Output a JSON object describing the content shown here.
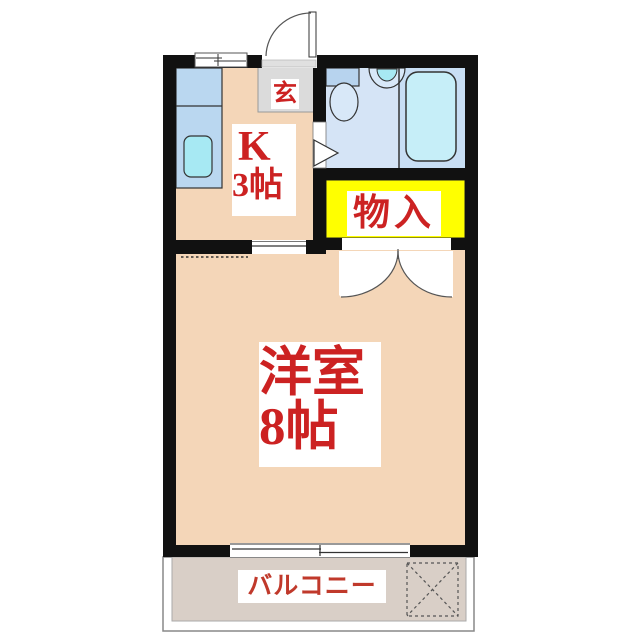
{
  "title": "1K apartment floor plan",
  "rooms": {
    "entrance": {
      "label": "玄"
    },
    "kitchen": {
      "label_line1": "K",
      "label_line2": "3帖"
    },
    "storage": {
      "label": "物入"
    },
    "main_room": {
      "label_line1": "洋室",
      "label_line2": "8帖"
    },
    "balcony": {
      "label": "バルコニー"
    }
  },
  "colors": {
    "wall": "#111111",
    "room_floor": "#f4d6b8",
    "bathroom_floor_left": "#d5e4f6",
    "bathroom_floor_right": "#c8def4",
    "storage_fill": "#ffff00",
    "entrance_fill": "#dbdbdb",
    "balcony_fill": "#d9cfc7",
    "kitchen_counter": "#bad7f0",
    "sink_cyan": "#a7e9f3",
    "bathtub_fill": "#c6eef8",
    "toilet_tank": "#b7d3ee",
    "label_text": "#cc2222",
    "label_bg": "#ffffff"
  }
}
